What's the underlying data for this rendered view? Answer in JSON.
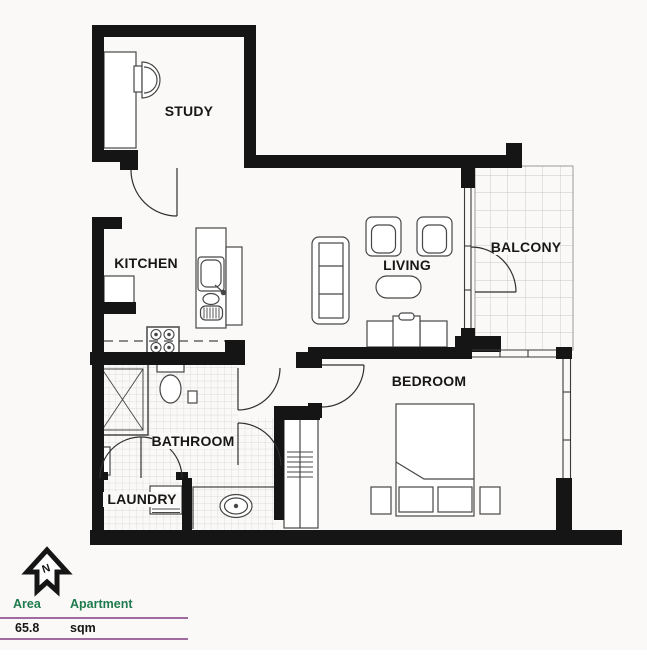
{
  "rooms": {
    "study": "STUDY",
    "kitchen": "KITCHEN",
    "living": "LIVING",
    "balcony": "BALCONY",
    "bathroom": "BATHROOM",
    "laundry": "LAUNDRY",
    "bedroom": "BEDROOM"
  },
  "compass": {
    "north_label": "N"
  },
  "legend": {
    "area_header": "Area",
    "apartment_header": "Apartment",
    "area_value": "65.8",
    "unit": "sqm"
  },
  "colors": {
    "wall": "#151515",
    "header_green": "#1e7b4d",
    "divider_plum": "#a06ba0",
    "background": "#faf9f7",
    "tile_line": "#d2d2d2"
  }
}
